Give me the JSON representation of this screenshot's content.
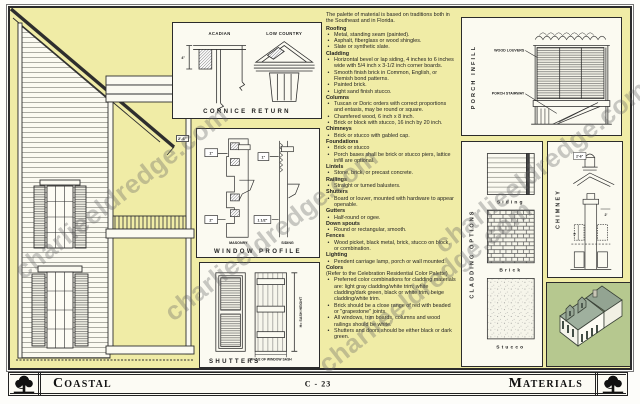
{
  "page": {
    "watermark": "charlieeldredge.com",
    "footer": {
      "left_title": "Coastal",
      "page_number": "C - 23",
      "right_title": "Materials"
    }
  },
  "panels": {
    "cornice": {
      "title": "CORNICE RETURN",
      "label_left": "ACADIAN",
      "label_right": "LOW COUNTRY",
      "dim": "4\""
    },
    "window_profile": {
      "title": "WINDOW PROFILE",
      "label_left": "MASONRY",
      "label_right": "SIDING",
      "dim_top_left": "1\"",
      "dim_top_right": "1\"",
      "dim_bottom_left": "2\"",
      "dim_bottom_right": "1 1/2\"",
      "dim_outside": "2'-6\""
    },
    "shutters": {
      "title": "SHUTTERS",
      "dim_height": "H= SASH HEIGHT",
      "dim_width": "W= 1/2 OF WINDOW SASH"
    },
    "porch_infill": {
      "title": "PORCH INFILL",
      "label_louvers": "WOOD LOUVERS",
      "label_stairway": "PORCH STAIRWAY"
    },
    "cladding": {
      "title": "CLADDING OPTIONS",
      "swatches": [
        "Siding",
        "Brick",
        "Stucco"
      ]
    },
    "chimney": {
      "title": "CHIMNEY",
      "dim_cap": "2'-6\"",
      "dim_width": "2'",
      "dim_height": "5'"
    }
  },
  "materials": {
    "intro": "The palette of material is based on traditions both in the Southeast and in Florida.",
    "sections": [
      {
        "heading": "Roofing",
        "items": [
          "Metal, standing seam (painted).",
          "Asphalt, fiberglass or wood shingles.",
          "Slate or synthetic slate."
        ]
      },
      {
        "heading": "Cladding",
        "items": [
          "Horizontal bevel or lap siding, 4 inches to 6 inches wide with 5/4 inch x 3-1/2 inch corner boards.",
          "Smooth finish brick in Common, English, or Flemish bond patterns.",
          "Painted brick.",
          "Light sand finish stucco."
        ]
      },
      {
        "heading": "Columns",
        "items": [
          "Tuscan or Doric orders with correct proportions and entasis,  may be round or square.",
          "Chamfered wood, 6 inch x 8 inch.",
          "Brick or block with stucco, 16 inch by 20 inch."
        ]
      },
      {
        "heading": "Chimneys",
        "items": [
          "Brick or stucco with gabled cap."
        ]
      },
      {
        "heading": "Foundations",
        "items": [
          "Brick or stucco",
          "Porch bases shall be brick or stucco piers, lattice infill are optional."
        ]
      },
      {
        "heading": "Lintels",
        "items": [
          "Stone, brick, or precast concrete."
        ]
      },
      {
        "heading": "Railings",
        "items": [
          "Straight or turned balusters."
        ]
      },
      {
        "heading": "Shutters",
        "items": [
          "Board or louver, mounted with hardware to appear openable."
        ]
      },
      {
        "heading": "Gutters",
        "items": [
          "Half-round or ogee."
        ]
      },
      {
        "heading": "Down spouts",
        "items": [
          "Round or rectangular, smooth."
        ]
      },
      {
        "heading": "Fences",
        "items": [
          "Wood picket, black metal, brick, stucco on block, or combination."
        ]
      },
      {
        "heading": "Lighting",
        "items": [
          "Pendent carriage lamp, porch or wall mounted."
        ]
      },
      {
        "heading": "Colors",
        "note": "(Refer to the Celebration Residential Color Palette)",
        "items": [
          "Preferred color combinations for cladding materials are:  light gray cladding/white trim; white cladding/dark green, black or white trim, beige cladding/white trim.",
          "Brick should be a close range of red with beaded or \"grapestone\" joints.",
          "All windows, trim boards, columns and wood railings should be white.",
          "Shutters and doors should be either black or dark green."
        ]
      }
    ]
  },
  "colors": {
    "page_background": "#f0eca6",
    "panel_background": "#fbfaf1",
    "line_ink": "#2b2b2b",
    "axon_field_green": "#b6c88f",
    "axon_roof_green": "#9fb09e"
  }
}
